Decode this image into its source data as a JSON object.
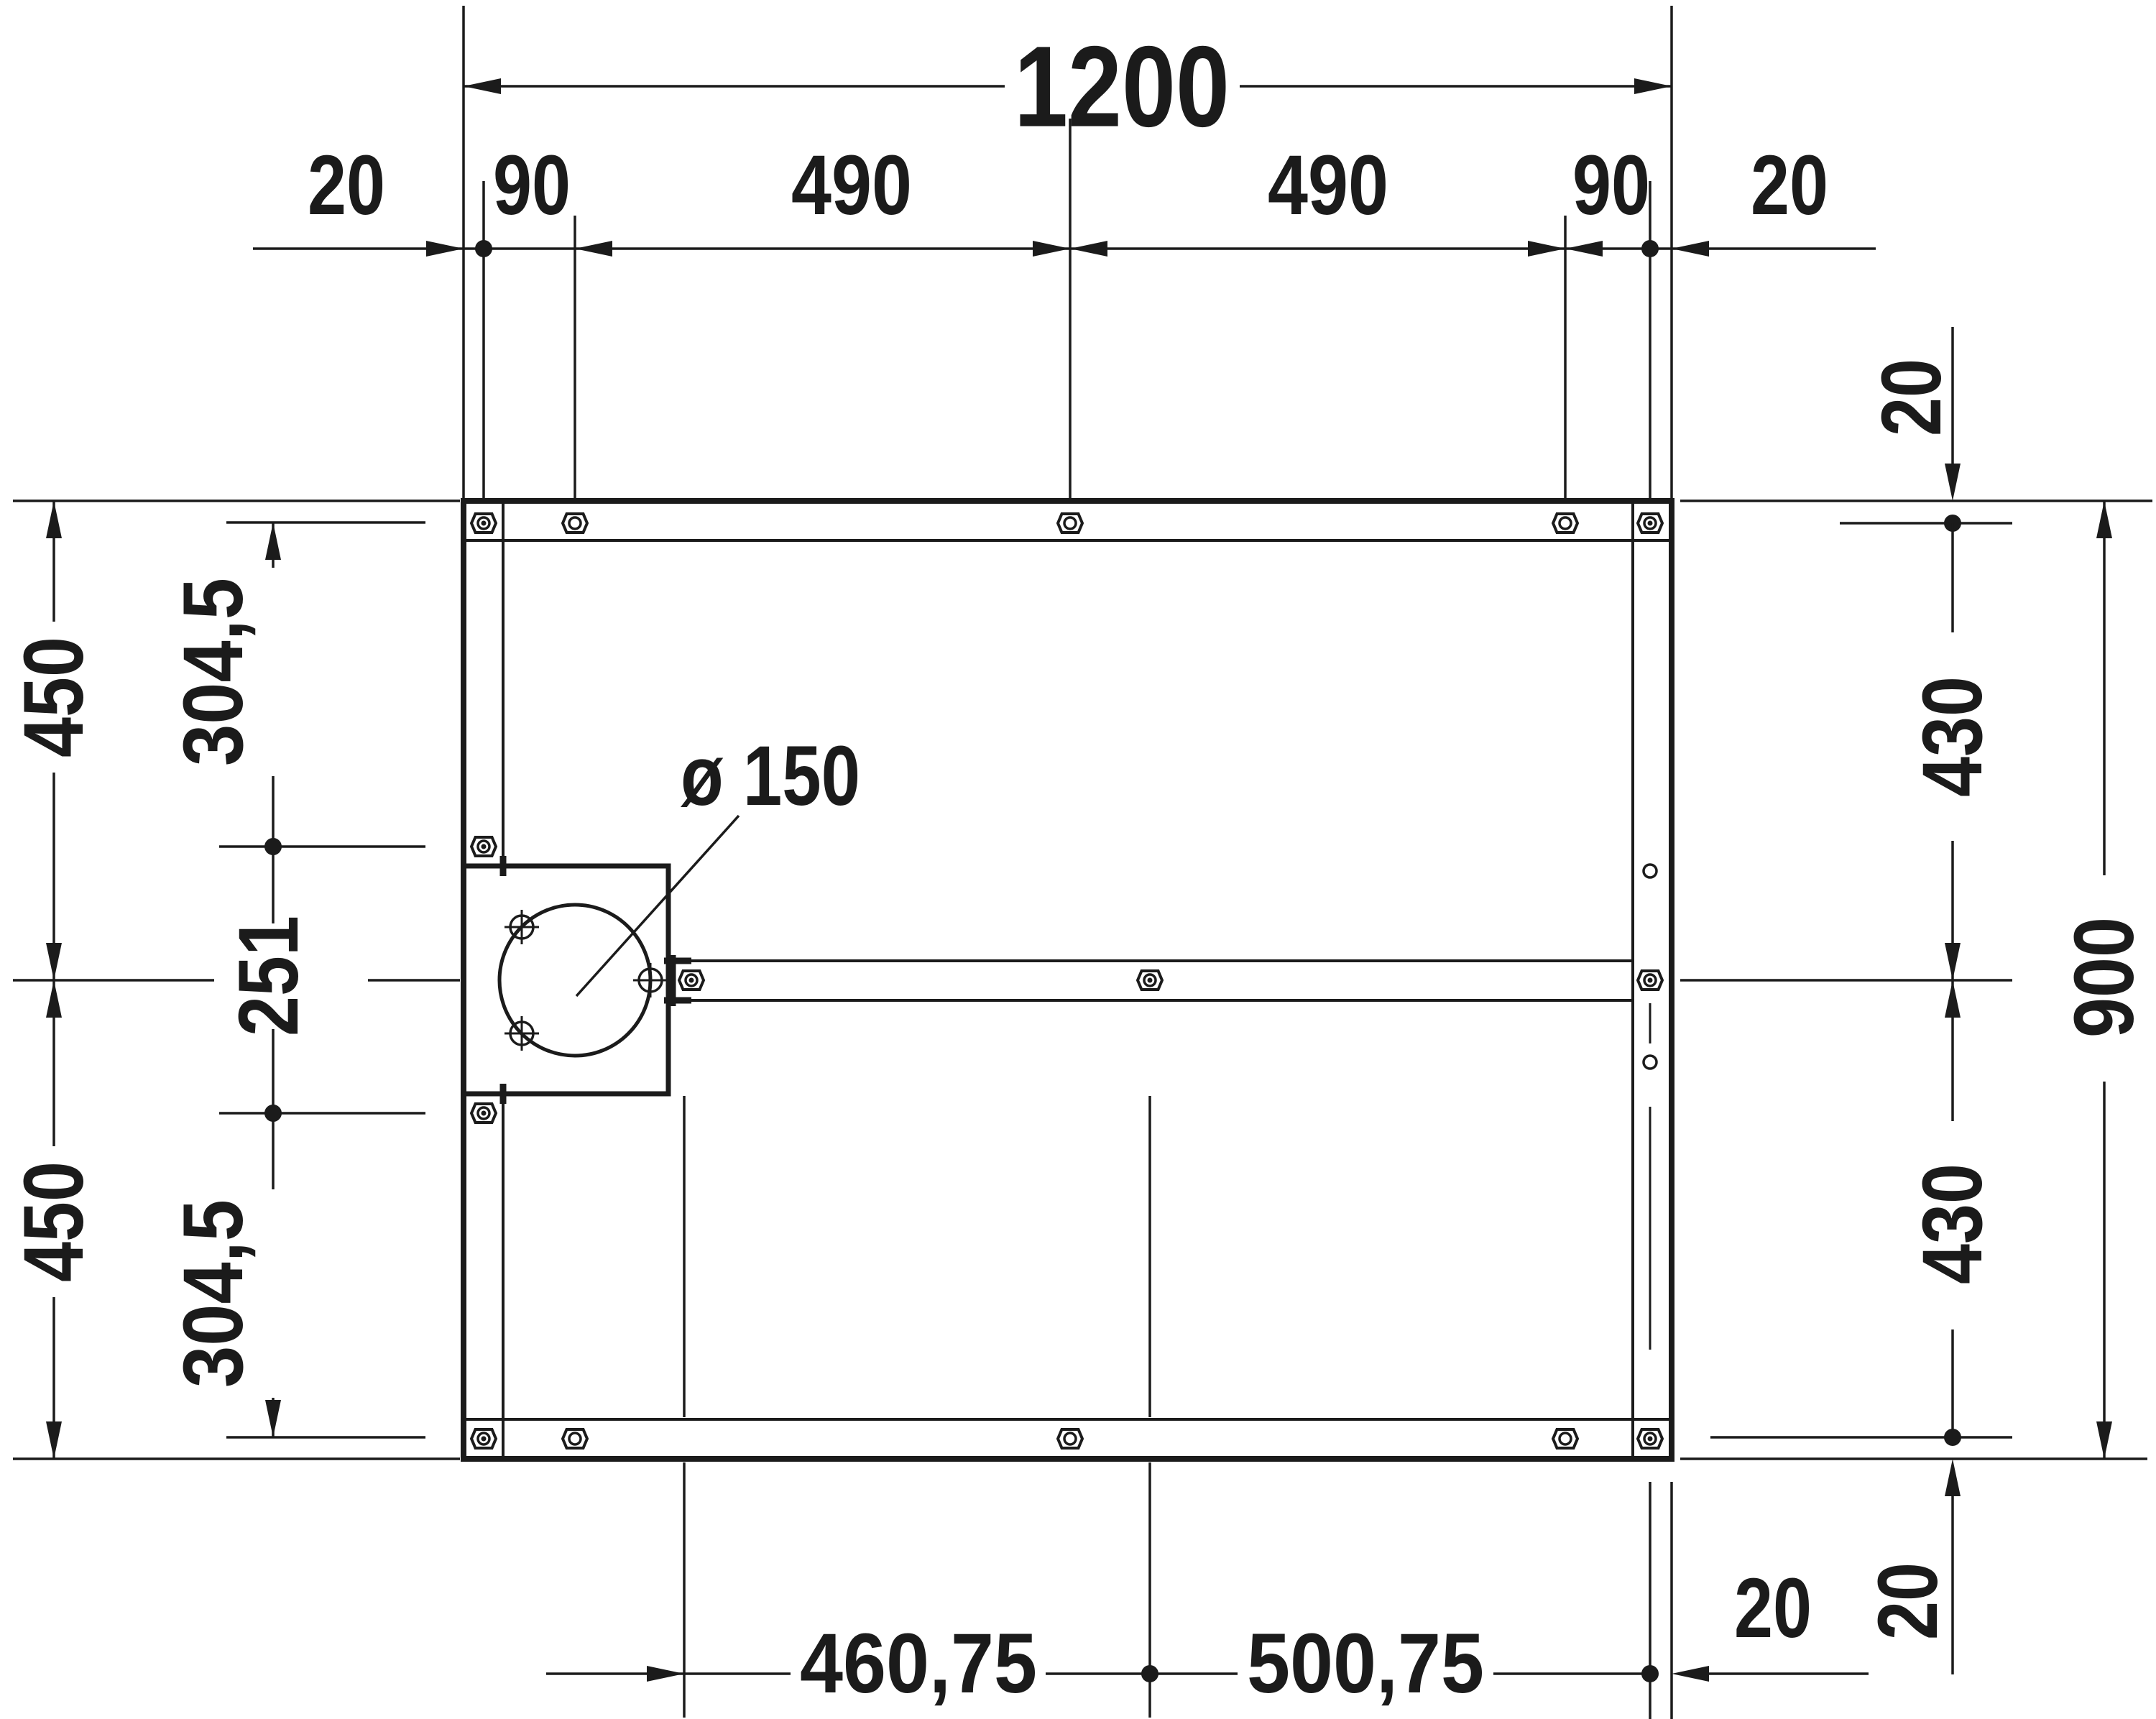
{
  "drawing": {
    "kind": "technical installation drawing - shower tray support frame (top view)",
    "units": "mm",
    "colors": {
      "line": "#1b1b1b",
      "background": "#ffffff"
    }
  },
  "dims": {
    "total_width": "1200",
    "total_height": "900",
    "top_chain": [
      "20",
      "90",
      "490",
      "490",
      "90",
      "20"
    ],
    "left_outer": [
      "450",
      "450"
    ],
    "left_inner": [
      "304,5",
      "251",
      "304,5"
    ],
    "right_top_offset": "20",
    "right_upper": "430",
    "right_lower": "430",
    "right_bottom_offset": "20",
    "bottom_left": "460,75",
    "bottom_right": "500,75",
    "bottom_offset": "20",
    "drain_diameter": "ø 150"
  }
}
